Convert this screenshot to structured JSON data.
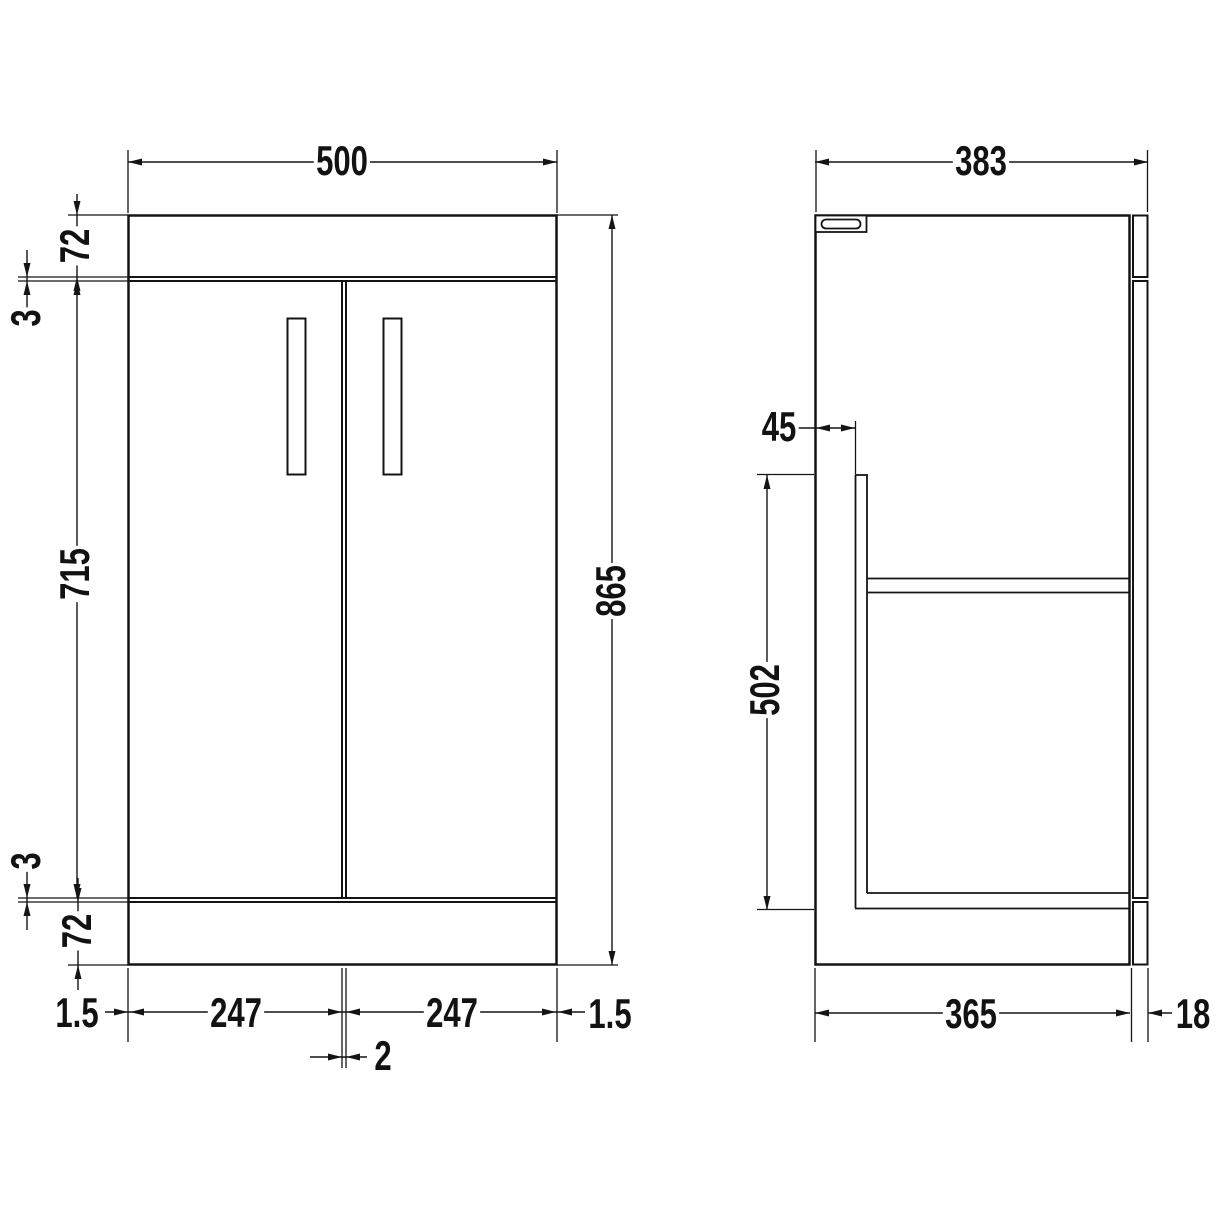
{
  "drawing": {
    "views": {
      "front": "front-elevation",
      "side": "side-section"
    },
    "colors": {
      "line": "#141414",
      "background": "#ffffff"
    }
  },
  "dimensions": {
    "front": {
      "overall_width": "500",
      "overall_height": "865",
      "top_panel_height": "72",
      "top_gap": "3",
      "door_height": "715",
      "bottom_gap": "3",
      "plinth_height": "72",
      "left_edge_offset": "1.5",
      "left_door_width": "247",
      "center_door_gap": "2",
      "right_door_width": "247",
      "right_edge_offset": "1.5"
    },
    "side": {
      "overall_depth": "383",
      "front_recess": "45",
      "interior_height": "502",
      "carcass_depth": "365",
      "door_thickness": "18"
    }
  }
}
